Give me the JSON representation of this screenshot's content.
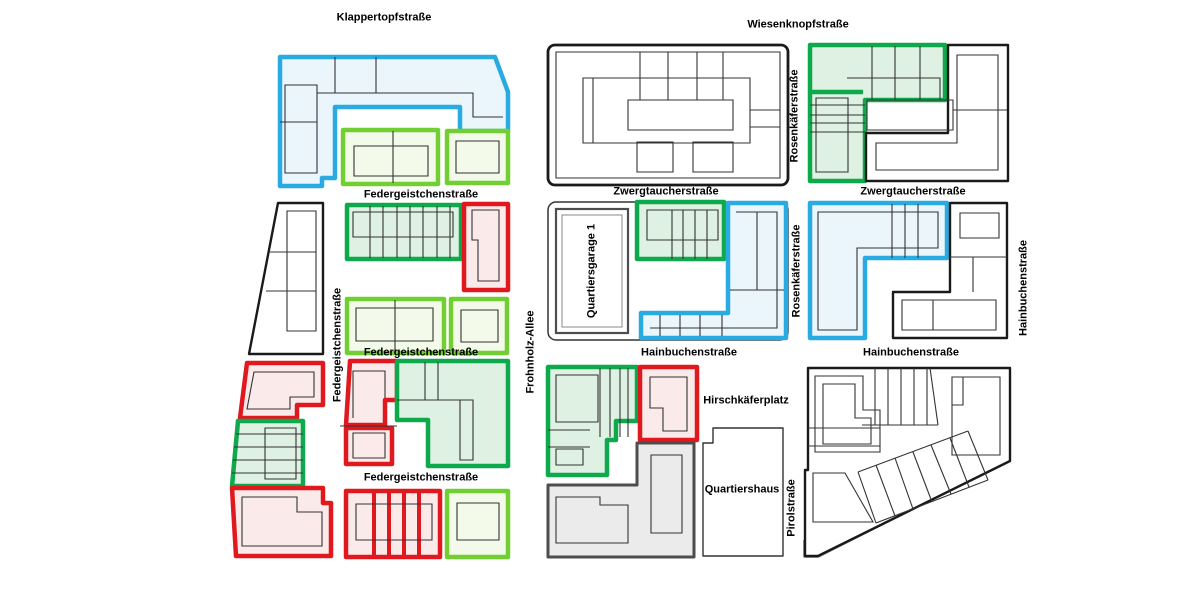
{
  "streets": {
    "klappertopfstrasse": "Klappertopfstraße",
    "wiesenknopfstrasse": "Wiesenknopfstraße",
    "federgeistchenstrasse": "Federgeistchenstraße",
    "zwergtaucherstrasse": "Zwergtaucherstraße",
    "hainbuchenstrasse": "Hainbuchenstraße",
    "frohnholz_allee": "Frohnholz-Allee",
    "rosenkaeferstrasse": "Rosenkäferstraße",
    "hirschkaeferplatz": "Hirschkäferplatz",
    "pirolstrasse": "Pirolstraße"
  },
  "buildings": {
    "quartiersgarage": "Quartiersgarage 1",
    "quartiershaus": "Quartiershaus"
  },
  "palette": {
    "blue_outline": "#29ABE2",
    "blue_fill": "#EAF6FC",
    "green_outline": "#0DA94C",
    "green_fill": "#DFF1E3",
    "lime_outline": "#72CF33",
    "lime_fill": "#F3FAEA",
    "red_outline": "#E0191F",
    "red_fill": "#FBEAEA",
    "black_outline": "#1A1A1A",
    "thin_line": "#333333",
    "gray_outline": "#4D4D4D",
    "gray_fill": "#EBEBEB",
    "background": "#FFFFFF",
    "label_color": "#000000"
  }
}
